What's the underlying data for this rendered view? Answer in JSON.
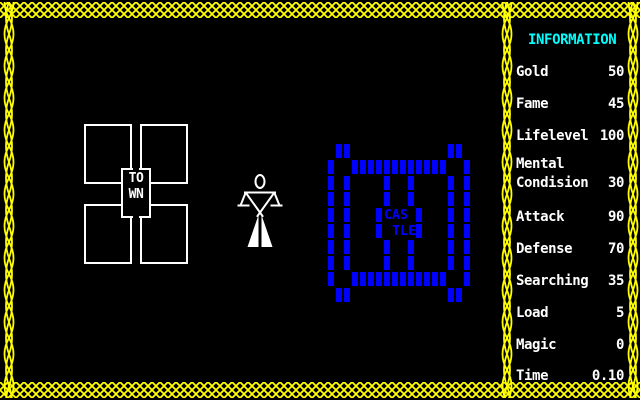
{
  "colors": {
    "background": "#000000",
    "border_yellow": "#ffff00",
    "castle_blue": "#0000ff",
    "title_cyan": "#00ffff",
    "text_white": "#ffffff"
  },
  "map": {
    "town": {
      "icon": "town-blocks-icon",
      "label_line1": "TO",
      "label_line2": "WN"
    },
    "player": {
      "icon": "person-figure-icon"
    },
    "castle": {
      "icon": "castle-walls-icon",
      "label_line1": "CAS",
      "label_line2": "TLE",
      "grid": [
        " ##            ## ",
        "#  ############  #",
        "# #    #  #    # #",
        "# #    #  #    # #",
        "# #   #CAS #   # #",
        "# #   # TLE#   # #",
        "# #    #  #    # #",
        "# #    #  #    # #",
        "#  ############  #",
        " ##            ## "
      ]
    }
  },
  "sidebar": {
    "title": "INFORMATION",
    "stats": [
      {
        "label": "Gold",
        "value": "50"
      },
      {
        "label": "Fame",
        "value": "45"
      },
      {
        "label": "Lifelevel",
        "value": "100"
      },
      {
        "label": "Mental",
        "label2": "Condision",
        "value": "30"
      },
      {
        "label": "Attack",
        "value": "90"
      },
      {
        "label": "Defense",
        "value": "70"
      },
      {
        "label": "Searching",
        "value": "35"
      },
      {
        "label": "Load",
        "value": "5"
      },
      {
        "label": "Magic",
        "value": "0"
      },
      {
        "label": "Time",
        "value": "0.10"
      }
    ]
  }
}
